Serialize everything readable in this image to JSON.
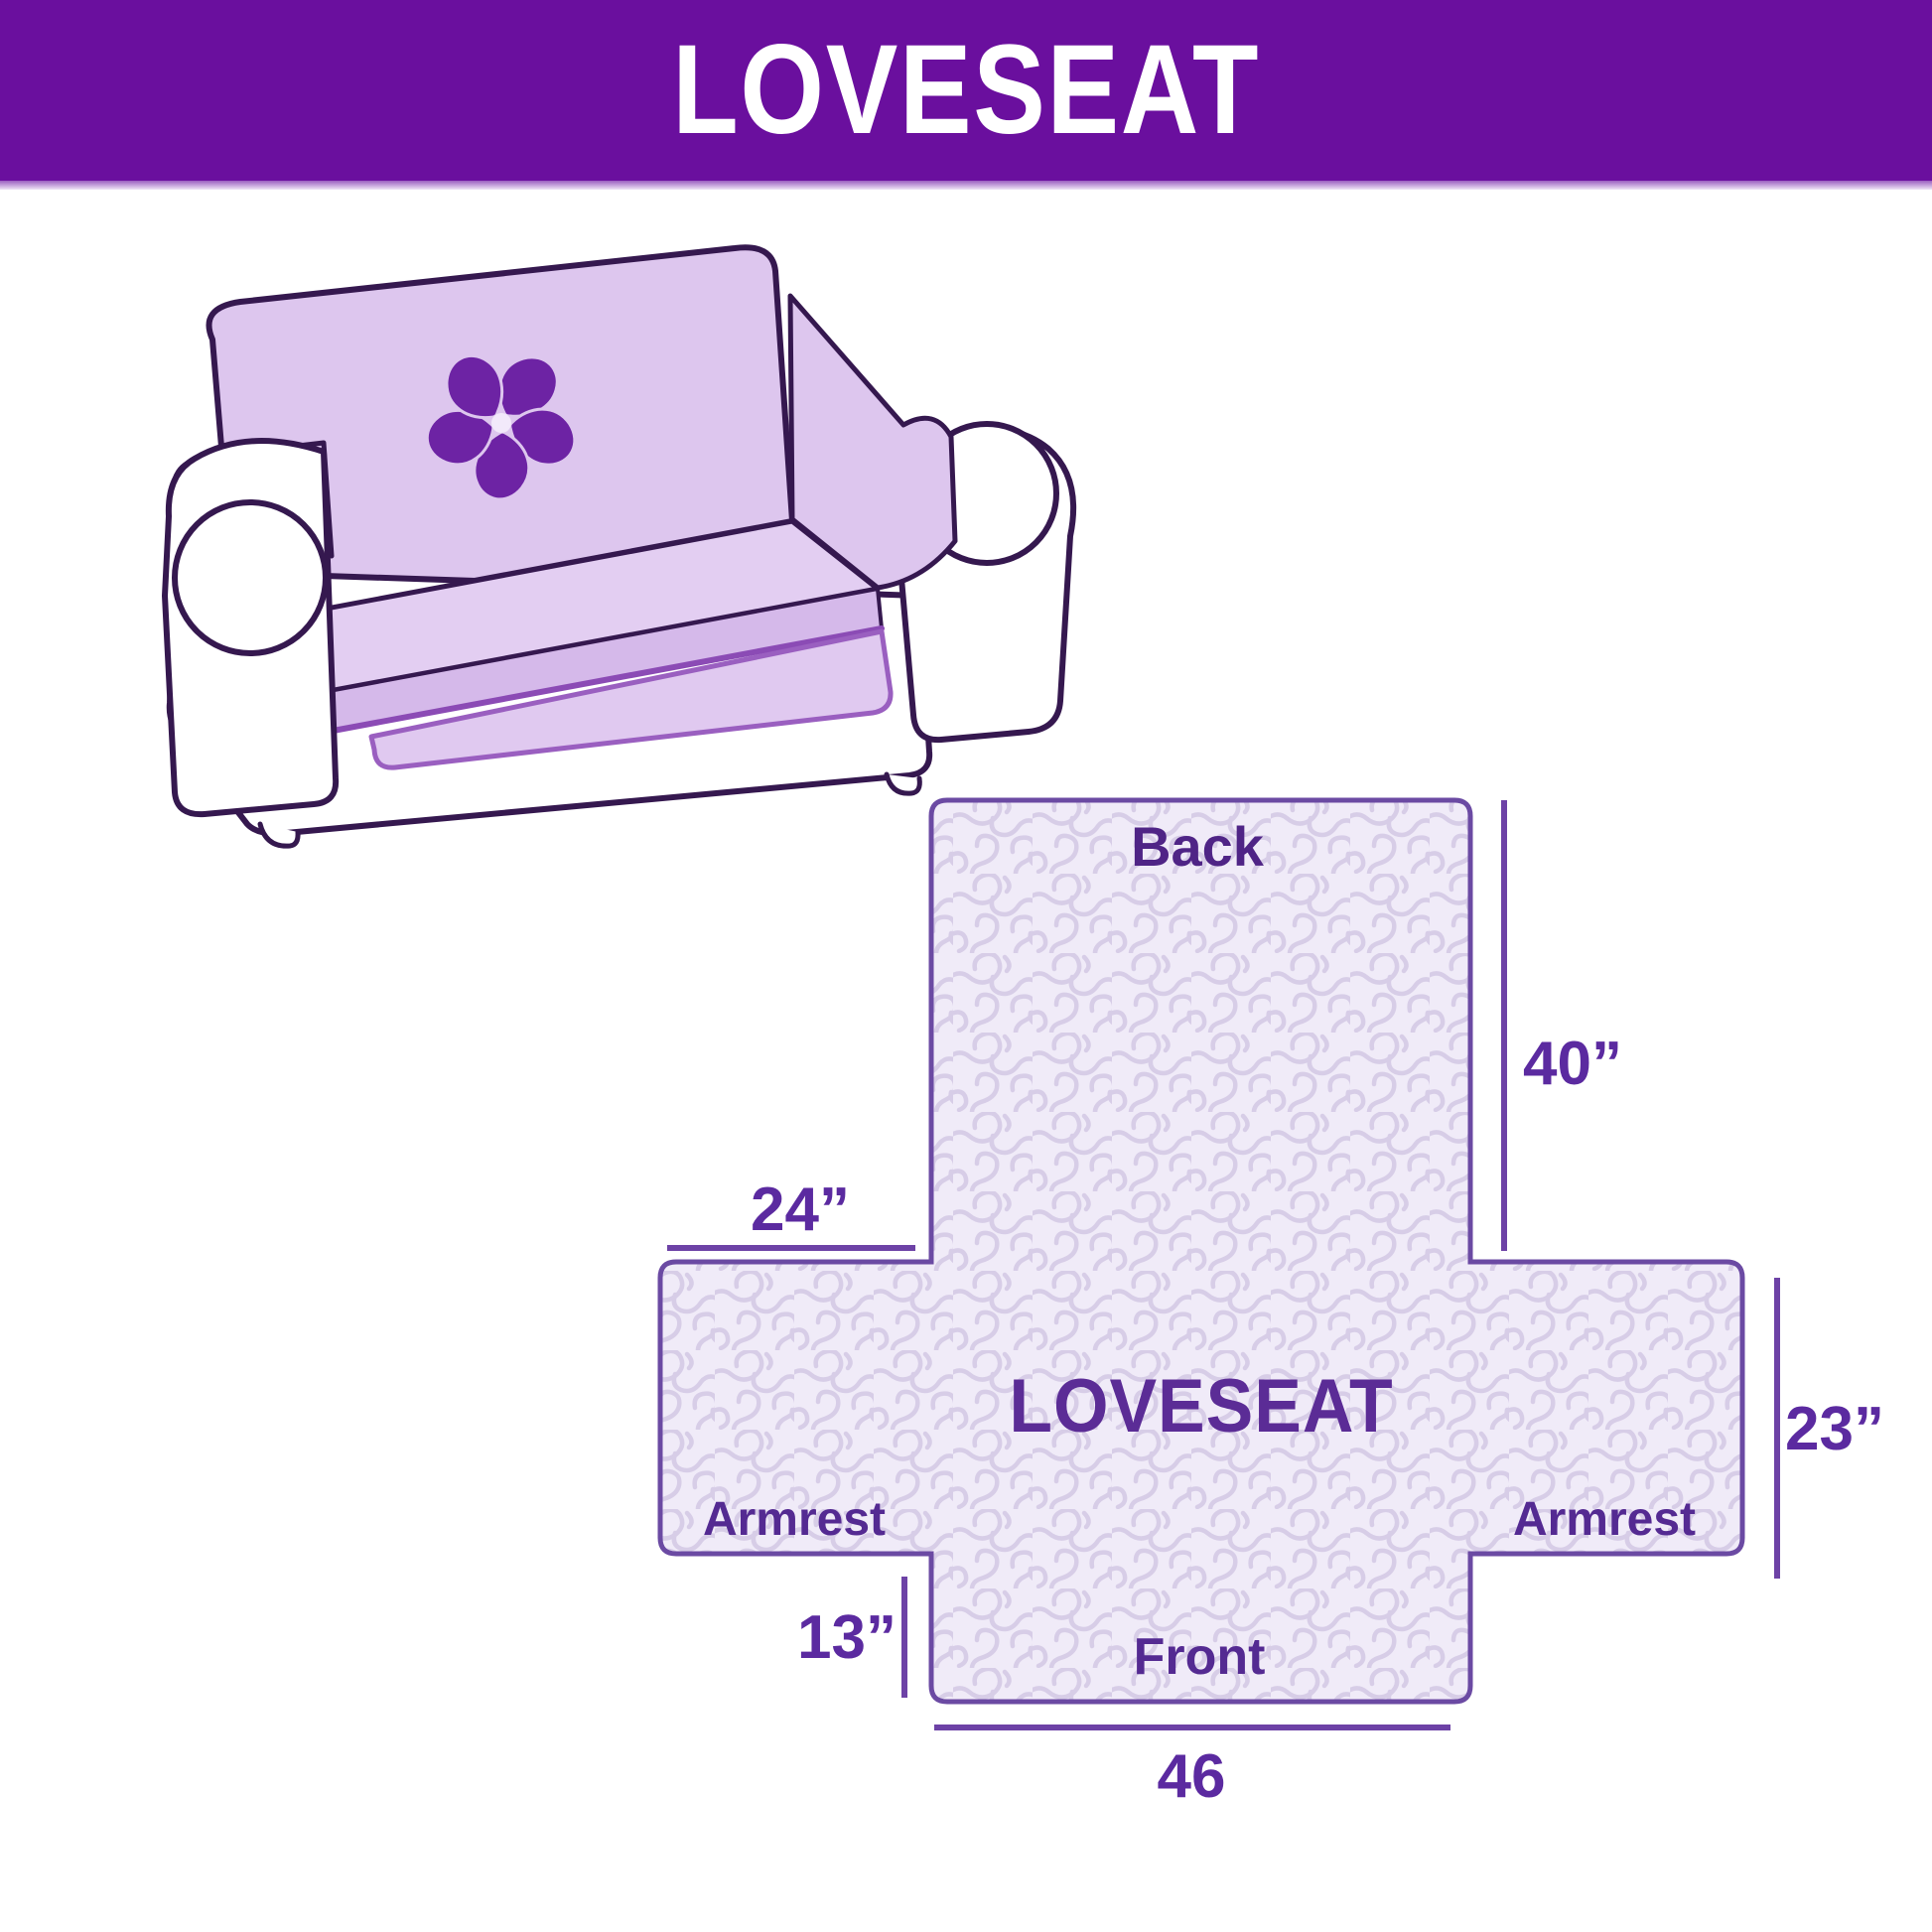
{
  "header": {
    "title": "LOVESEAT"
  },
  "illustration": {
    "subject": "loveseat sofa with quilted slipcover",
    "logo": "pinwheel-icon"
  },
  "diagram": {
    "title": "LOVESEAT",
    "sections": {
      "back": "Back",
      "front": "Front",
      "armrest_left": "Armrest",
      "armrest_right": "Armrest"
    },
    "dimensions": {
      "back_height": "40”",
      "back_top_width": "24”",
      "armrest_height": "23”",
      "front_skirt_height": "13”",
      "front_width": "46"
    }
  },
  "colors": {
    "header_bg": "#6a0f9e",
    "header_text": "#ffffff",
    "section_label_text": "#542a92",
    "dimension_text": "#5b2aa0",
    "diagram_outline": "#6b4aa3",
    "dimension_line": "#6d42a6",
    "quilt_fill": "#f0ebf8",
    "quilt_squiggle": "#d7cde7",
    "cover_lavender": "#ddc6ee",
    "pinwheel": "#6d23a4",
    "couch_outline": "#35184f"
  }
}
